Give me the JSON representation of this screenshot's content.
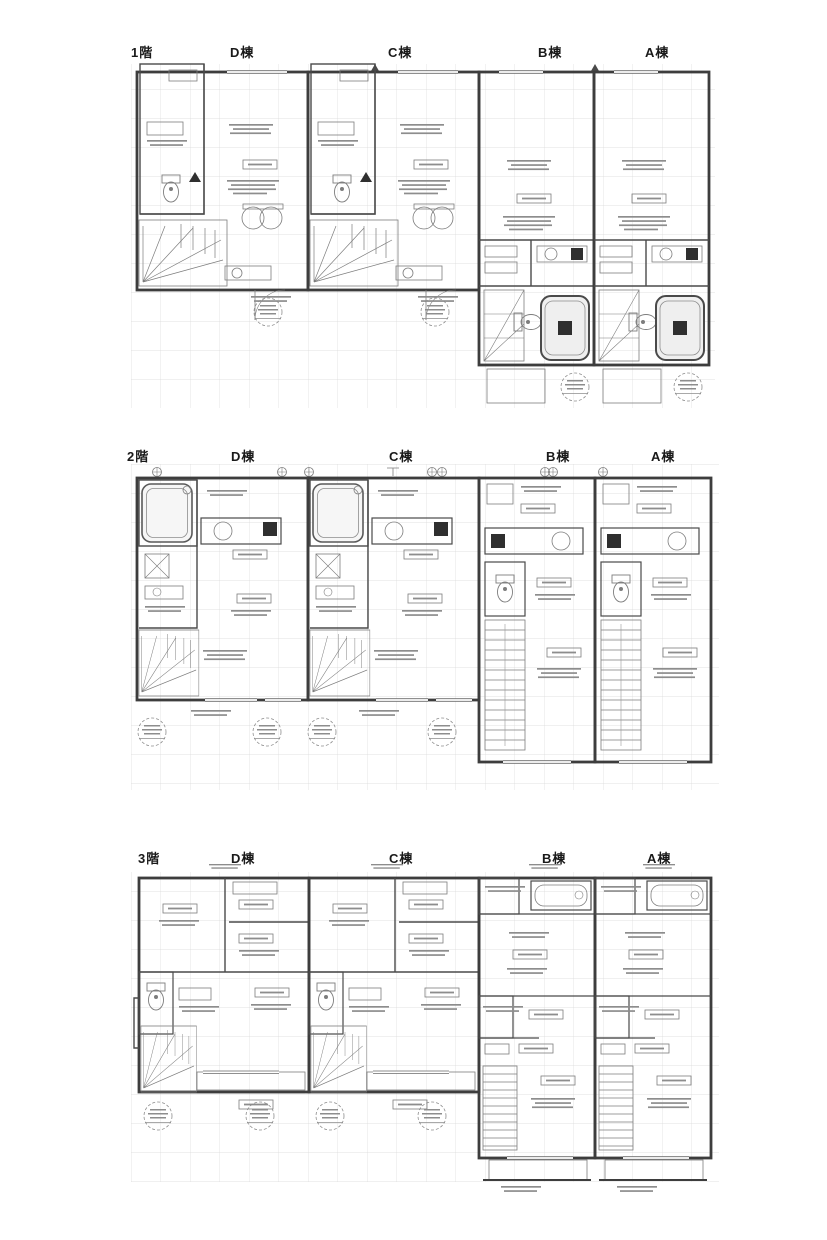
{
  "colors": {
    "paper": "#ffffff",
    "wall_line": "#3d3d3d",
    "thin_line": "#7d7d7d",
    "grid_line": "#d9d9d9",
    "label_text": "#1a1a1a"
  },
  "floors": [
    {
      "floor_label": "1階",
      "units": [
        {
          "label": "D棟"
        },
        {
          "label": "C棟"
        },
        {
          "label": "B棟"
        },
        {
          "label": "A棟"
        }
      ]
    },
    {
      "floor_label": "2階",
      "units": [
        {
          "label": "D棟"
        },
        {
          "label": "C棟"
        },
        {
          "label": "B棟"
        },
        {
          "label": "A棟"
        }
      ]
    },
    {
      "floor_label": "3階",
      "units": [
        {
          "label": "D棟"
        },
        {
          "label": "C棟"
        },
        {
          "label": "B棟"
        },
        {
          "label": "A棟"
        }
      ]
    }
  ]
}
